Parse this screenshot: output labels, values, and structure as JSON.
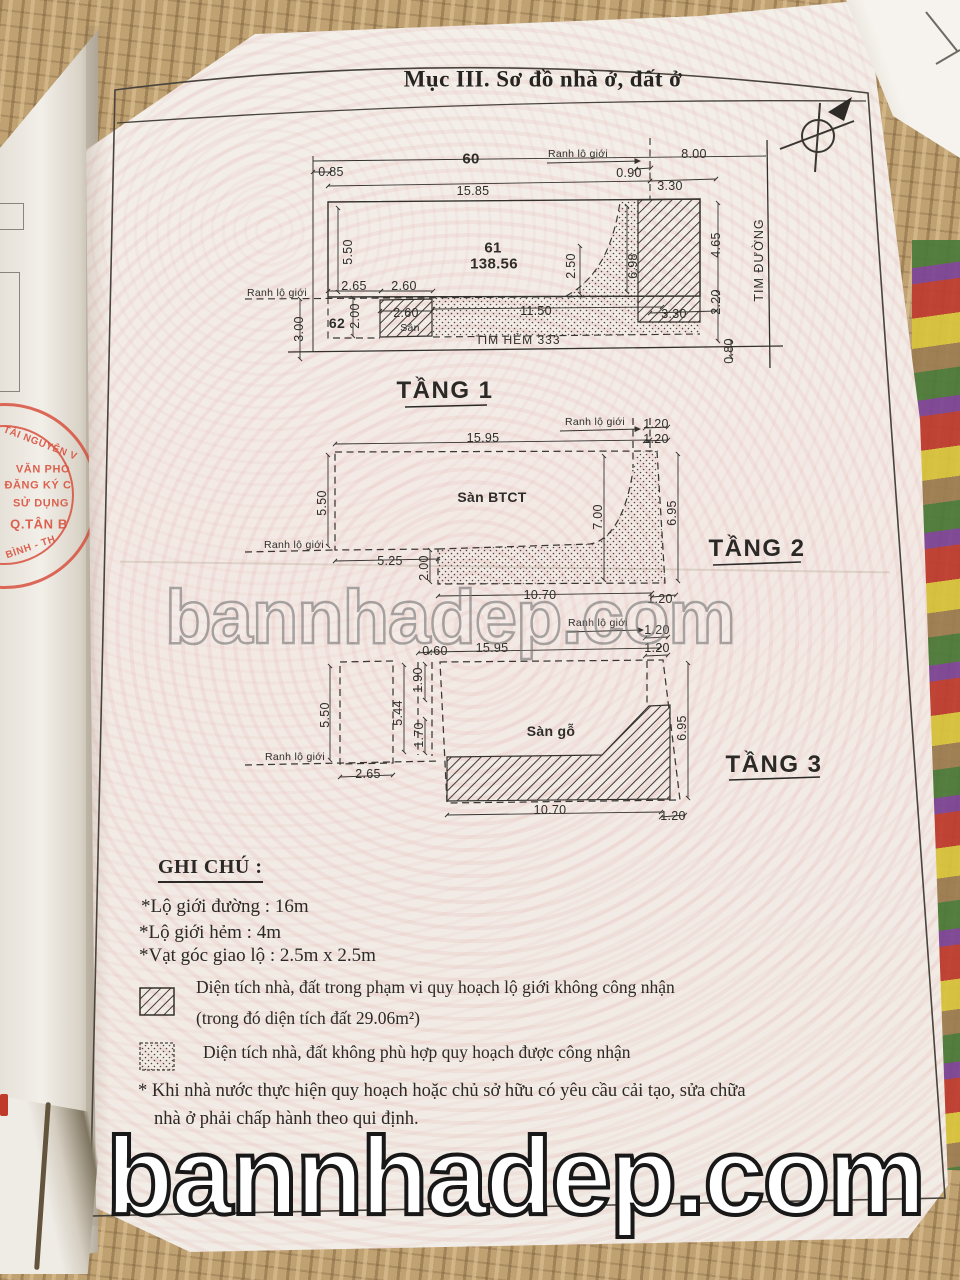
{
  "page": {
    "section_title": "Mục III. Sơ đồ nhà ở, đất ở",
    "watermark_center": "bannhadep.com",
    "watermark_bottom": "bannhadep.com"
  },
  "stamp": {
    "arc_top": "TÀI NGUYÊN V",
    "line1": "VĂN PHÒ",
    "line2": "ĐĂNG KÝ C",
    "line3": "SỬ DỤNG",
    "line4": "Q.TÂN B",
    "arc_bottom": "BÌNH - TH"
  },
  "floor1": {
    "name": "TẦNG 1",
    "lot_left": "60",
    "lot_main": "61",
    "area": "138.56",
    "lot_below": "62",
    "ranh_top": "Ranh lộ giới",
    "ranh_left": "Ranh lộ giới",
    "tim_duong": "TIM ĐƯỜNG",
    "tim_hem": "TIM HẺM 333",
    "san": "Sân",
    "dims": {
      "w085": "0.85",
      "w1585": "15.85",
      "w090": "0.90",
      "w330t": "3.30",
      "w800": "8.00",
      "h550": "5.50",
      "h250": "2.50",
      "h698": "6.98",
      "h465": "4.65",
      "w265": "2.65",
      "w260a": "2.60",
      "w260b": "2.60",
      "w1150": "11.50",
      "w330b": "3.30",
      "h200": "2.00",
      "h220": "2.20",
      "h300": "3.00",
      "h080": "0.80"
    }
  },
  "floor2": {
    "name": "TẦNG 2",
    "label": "Sàn BTCT",
    "ranh_top": "Ranh lộ giới",
    "ranh_left": "Ranh lộ giới",
    "dims": {
      "w120a": "1.20",
      "w120b": "1.20",
      "w1595": "15.95",
      "h550": "5.50",
      "h700": "7.00",
      "h695": "6.95",
      "w525": "5.25",
      "h200": "2.00",
      "w1070": "10.70",
      "w120c": "1.20"
    }
  },
  "floor3": {
    "name": "TẦNG 3",
    "label": "Sàn gỗ",
    "ranh_top": "Ranh lộ giới",
    "ranh_left": "Ranh lộ giới",
    "dims": {
      "w120a": "1.20",
      "w120b": "1.20",
      "w060": "0.60",
      "w1595": "15.95",
      "h550": "5.50",
      "h544": "5.44",
      "h190": "1.90",
      "h170": "1.70",
      "h695": "6.95",
      "w265": "2.65",
      "w1070": "10.70",
      "w120c": "1.20"
    }
  },
  "notes": {
    "heading": "GHI CHÚ :",
    "items": [
      "*Lộ giới đường : 16m",
      "*Lộ giới hẻm : 4m",
      "*Vạt góc giao lộ : 2.5m x 2.5m"
    ],
    "legend_hatch_line1": "Diện tích nhà, đất trong phạm vi quy hoạch lộ giới không công nhận",
    "legend_hatch_line2": "(trong đó diện tích đất 29.06m²)",
    "legend_dots": "Diện tích nhà, đất không phù hợp quy hoạch được công nhận",
    "footnote_line1": "* Khi nhà nước thực hiện quy hoạch hoặc chủ sở hữu có yêu cầu cải tạo, sửa chữa",
    "footnote_line2": "nhà ở phải chấp hành theo qui định."
  },
  "colors": {
    "stamp_red": "#d9523f",
    "paper": "#f2ede7",
    "ink": "#343230"
  }
}
